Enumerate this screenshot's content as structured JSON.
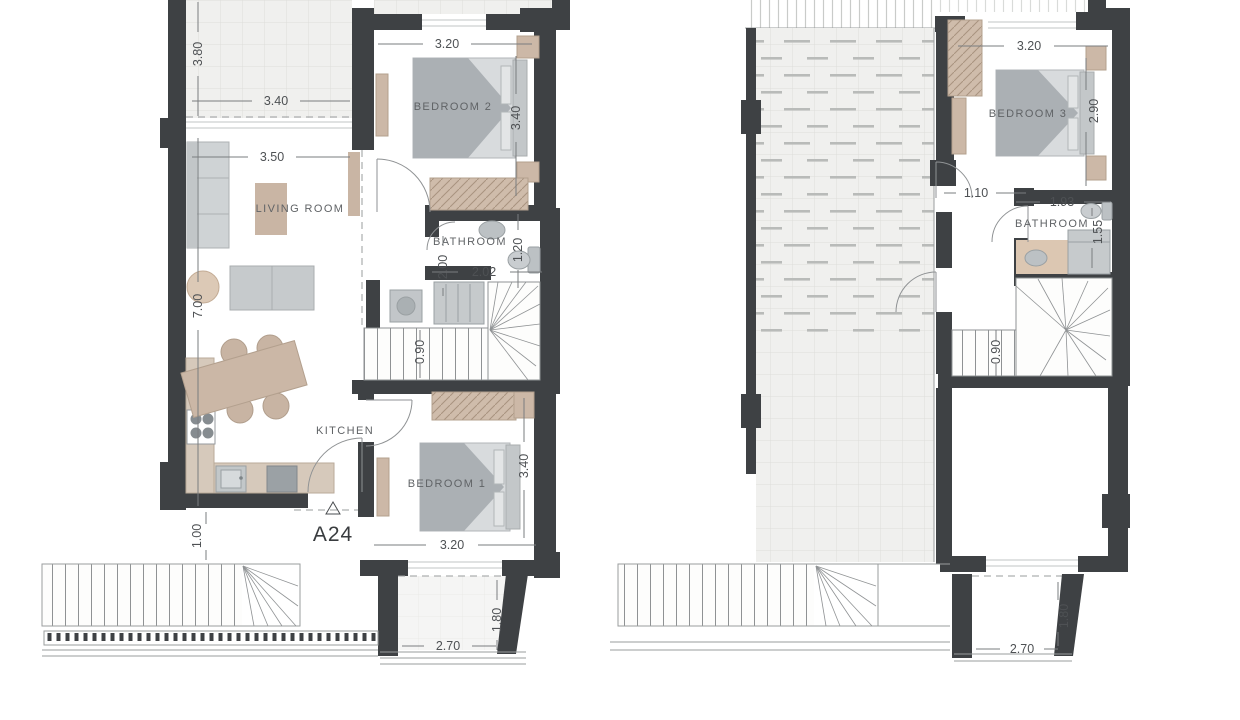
{
  "unit": {
    "label": "A24"
  },
  "floors": {
    "ground": {
      "rooms": {
        "living": "LIVING ROOM",
        "kitchen": "KITCHEN",
        "bedroom2": "BEDROOM 2",
        "bathroom": "BATHROOM",
        "bedroom1": "BEDROOM 1"
      },
      "dims": {
        "terrace_depth": "3.80",
        "terrace_width": "3.40",
        "living_width": "3.50",
        "living_depth": "7.00",
        "bedroom2_width": "3.20",
        "bedroom2_depth": "3.40",
        "hall": "2.00",
        "bathroom_width": "2.02",
        "bathroom_depth": "1.20",
        "stair_width": "0.90",
        "entry_offset": "1.00",
        "bedroom1_width": "3.20",
        "bedroom1_depth": "3.40",
        "balcony_width": "2.70",
        "balcony_depth": "1.80"
      }
    },
    "first": {
      "rooms": {
        "bedroom3": "BEDROOM 3",
        "bathroom": "BATHROOM"
      },
      "dims": {
        "bedroom3_width": "3.20",
        "bedroom3_depth": "2.90",
        "landing": "1.10",
        "bathroom_width": "1.93",
        "bathroom_depth": "1.55",
        "stair_width": "0.90",
        "balcony_width": "2.70",
        "balcony_depth": "1.80"
      }
    }
  },
  "colors": {
    "wall": "#3e4144",
    "furniture_gray": "#ced2d4",
    "furniture_tan": "#ccb8a7",
    "dim_text": "#4e5154"
  }
}
